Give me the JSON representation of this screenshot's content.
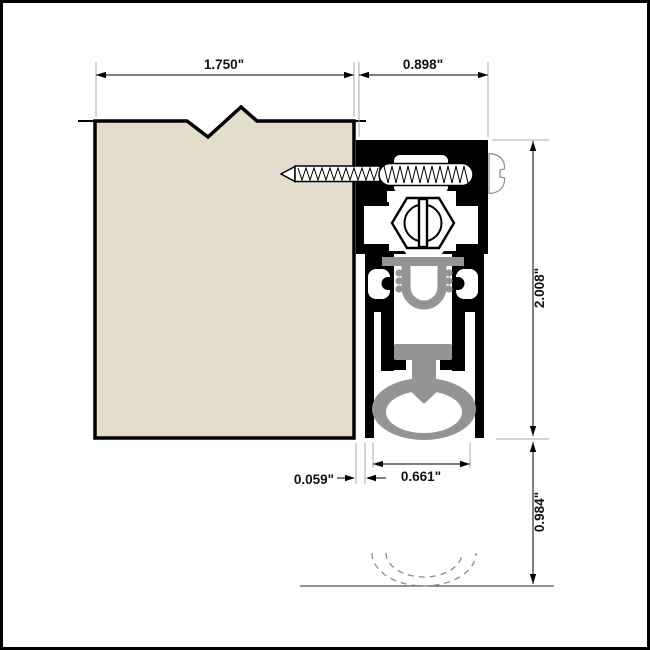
{
  "drawing": {
    "type": "technical-cross-section",
    "subject": "automatic-door-bottom-seal-profile",
    "dimensions": {
      "door_thickness": "1.750\"",
      "housing_width": "0.898\"",
      "housing_height": "2.008\"",
      "drop_distance": "0.984\"",
      "seal_width": "0.661\"",
      "clearance_gap": "0.059\""
    },
    "colors": {
      "background": "#ffffff",
      "frame_border": "#000000",
      "door_fill": "#e4ddcb",
      "housing": "#000000",
      "seal_gray": "#949494",
      "outline": "#000000",
      "dim_line": "#000000",
      "extension_line": "#a8a8a8",
      "floor_line": "#555555",
      "dashed_arc": "#8a8a8a",
      "screw_head_line": "#8a8a8a"
    }
  }
}
